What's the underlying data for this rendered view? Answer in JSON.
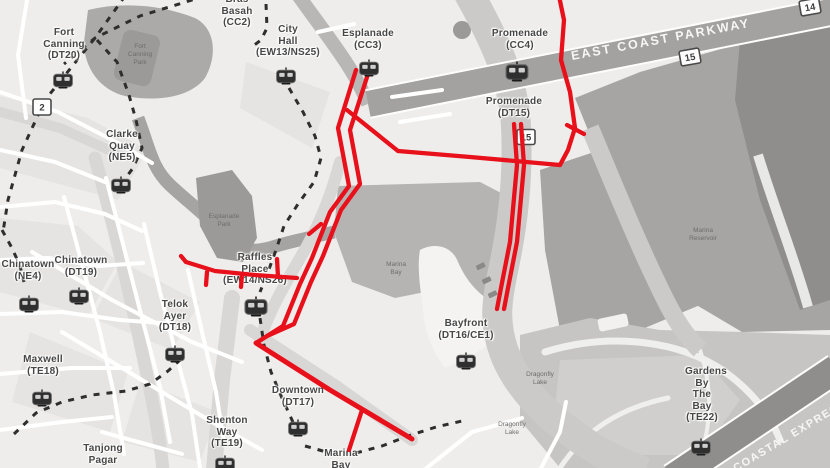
{
  "colors": {
    "land": "#eeedeb",
    "block": "#e5e4e2",
    "street": "#ffffff",
    "corridor": "#d8d7d5",
    "road_band": "#a3a2a0",
    "bridge": "#cbcac8",
    "water": "#b5b4b2",
    "water_dark": "#a6a5a3",
    "water_darker": "#8f8e8c",
    "river": "#a5a4a2",
    "park": "#abaaa8",
    "park_dark": "#9b9a98",
    "gardens": "#c6c5c3",
    "mce": "#8f8e8c",
    "dashed": "#2e2e2e",
    "route": "#e8101a",
    "label": "#474747",
    "shield_border": "#4a4a4a",
    "road_text": "#f6f6f6",
    "tiny_label": "#6d6d6d"
  },
  "stations": [
    {
      "name": "Fort Canning",
      "code": "(DT20)"
    },
    {
      "name": "Bras Basah",
      "code": "(CC2)"
    },
    {
      "name": "City Hall",
      "code": "(EW13/NS25)"
    },
    {
      "name": "Esplanade",
      "code": "(CC3)"
    },
    {
      "name": "Promenade",
      "code": "(CC4)"
    },
    {
      "name": "Promenade",
      "code": "(DT15)"
    },
    {
      "name": "Clarke Quay",
      "code": "(NE5)"
    },
    {
      "name": "Chinatown",
      "code": "(NE4)"
    },
    {
      "name": "Chinatown",
      "code": "(DT19)"
    },
    {
      "name": "Raffles Place",
      "code": "(EW14/NS26)"
    },
    {
      "name": "Telok Ayer",
      "code": "(DT18)"
    },
    {
      "name": "Maxwell",
      "code": "(TE18)"
    },
    {
      "name": "Bayfront",
      "code": "(DT16/CE1)"
    },
    {
      "name": "Downtown",
      "code": "(DT17)"
    },
    {
      "name": "Shenton Way",
      "code": "(TE19)"
    },
    {
      "name": "Tanjong Pagar",
      "code": ""
    },
    {
      "name": "Marina Bay",
      "code": ""
    },
    {
      "name": "Gardens By The Bay",
      "code": "(TE22)"
    }
  ],
  "roads": {
    "ecp": "EAST COAST PARKWAY",
    "mce": "COASTAL EXPRESSWAY"
  },
  "shields": [
    "2",
    "15",
    "14",
    "15"
  ],
  "areas": [
    {
      "lines": [
        "Fort",
        "Canning",
        "Park"
      ]
    },
    {
      "lines": [
        "Esplanade",
        "Park"
      ]
    },
    {
      "lines": [
        "Marina",
        "Bay"
      ]
    },
    {
      "lines": [
        "Marina",
        "Reservoir"
      ]
    },
    {
      "lines": [
        "Dragonfly",
        "Lake"
      ]
    },
    {
      "lines": [
        "Dragonfly",
        "Lake"
      ]
    }
  ]
}
